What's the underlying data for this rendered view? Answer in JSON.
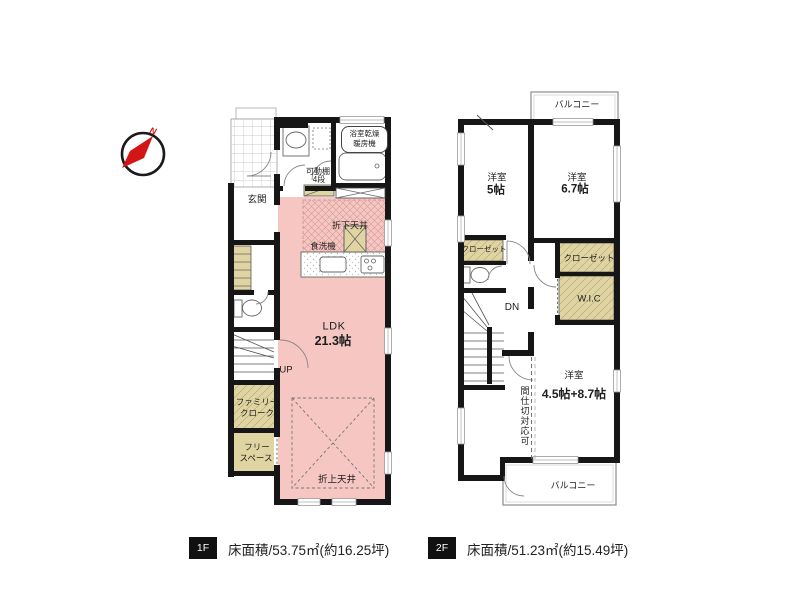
{
  "compass": {
    "north_label": "N"
  },
  "floor1": {
    "entrance": "玄関",
    "bath_dryer_line1": "浴室乾燥",
    "bath_dryer_line2": "暖房機",
    "movable_shelf_line1": "可動棚",
    "movable_shelf_line2": "4段",
    "lowered_ceiling": "折下天井",
    "dishwasher": "食洗機",
    "ldk_name": "LDK",
    "ldk_area": "21.3帖",
    "stairs_up": "UP",
    "family_closet_line1": "ファミリー",
    "family_closet_line2": "クローク",
    "free_space_line1": "フリー",
    "free_space_line2": "スペース",
    "raised_ceiling": "折上天井"
  },
  "floor2": {
    "balcony_top": "バルコニー",
    "room5_name": "洋室",
    "room5_area": "5帖",
    "room67_name": "洋室",
    "room67_area": "6.7帖",
    "closet_left": "クローゼット",
    "closet_right": "クローゼット",
    "wic": "W.I.C",
    "stairs_down": "DN",
    "room_main_name": "洋室",
    "room_main_area": "4.5帖+8.7帖",
    "partition_note": "間仕切対応可",
    "balcony_bottom": "バルコニー"
  },
  "footer": {
    "floor1_badge": "1F",
    "floor1_area": "床面積/53.75㎡(約16.25坪)",
    "floor2_badge": "2F",
    "floor2_area": "床面積/51.23㎡(約15.49坪)"
  },
  "colors": {
    "room_pink": "#f5c6c2",
    "closet_beige": "#e0d5a2",
    "wall": "#161616",
    "compass_red": "#d21616"
  }
}
